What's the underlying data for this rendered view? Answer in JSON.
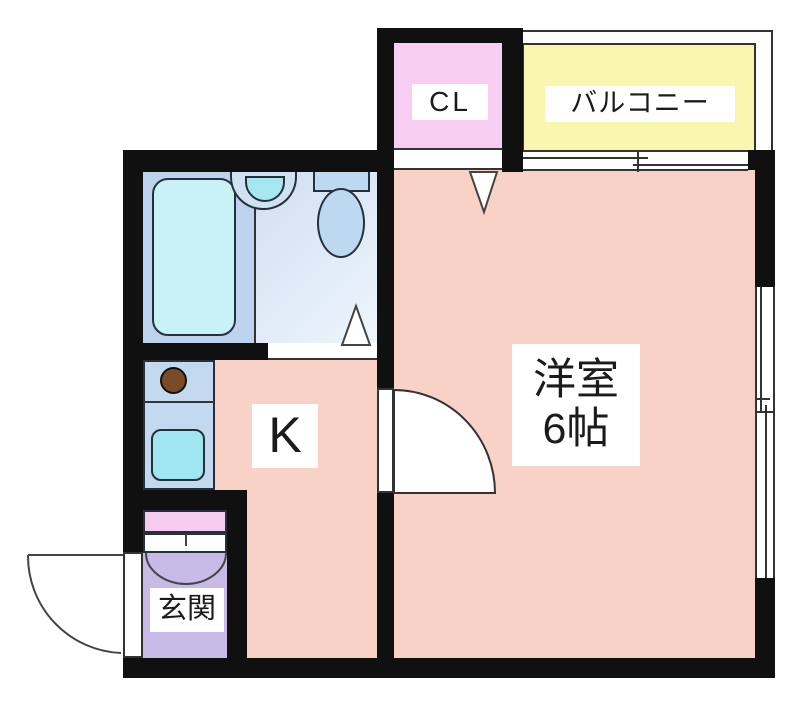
{
  "floorplan": {
    "rooms": {
      "closet": {
        "label": "CL"
      },
      "balcony": {
        "label": "バルコニー"
      },
      "western_room": {
        "name": "洋室",
        "size": "6帖"
      },
      "kitchen": {
        "label": "K"
      },
      "entrance": {
        "label": "玄関"
      }
    },
    "colors": {
      "wall_black": "#101010",
      "room_salmon": "#f8d2c6",
      "closet_pink": "#f7cef2",
      "shoe_cabinet_pink": "#f8cbf0",
      "balcony_yellow": "#f9f6b0",
      "entrance_purple": "#c7bae7",
      "bath_zone_blue": "#bdd2ec",
      "washroom_blue": "#dfeaf7",
      "bathtub_cyan": "#c9f2f7",
      "fixture_blue": "#bdd8f1",
      "basin_cyan": "#a5e8f0",
      "counter_blue": "#c3d9f0",
      "kitchen_sink_cyan": "#9fe6f0",
      "stove_brown": "#7b4a26",
      "label_text": "#1b1b1b"
    }
  }
}
